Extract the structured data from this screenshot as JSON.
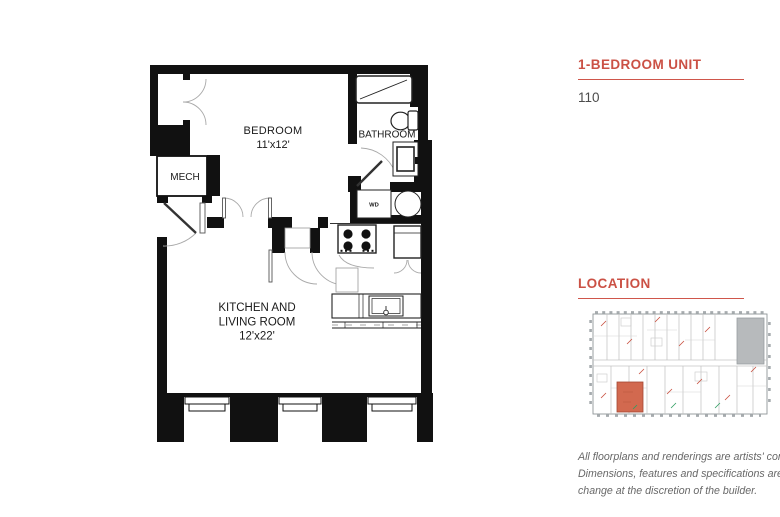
{
  "floorplan": {
    "bedroom": {
      "name": "BEDROOM",
      "dims": "11'x12'"
    },
    "bathroom": {
      "name": "BATHROOM"
    },
    "mech": {
      "name": "MECH"
    },
    "washer_dryer": {
      "name": "WD"
    },
    "kitchen_living": {
      "line1": "KITCHEN AND",
      "line2": "LIVING ROOM",
      "dims": "12'x22'"
    }
  },
  "panel": {
    "unit_title": "1-BEDROOM UNIT",
    "unit_number": "110",
    "location_title": "LOCATION",
    "disclaimer": [
      "All floorplans and renderings are artists' conception.",
      "Dimensions, features and specifications are subject to",
      "change at the discretion of the builder."
    ],
    "accent_color": "#cb5145"
  },
  "location_map": {
    "highlight_color": "#d2694f",
    "amenity_color": "#b7babc"
  }
}
